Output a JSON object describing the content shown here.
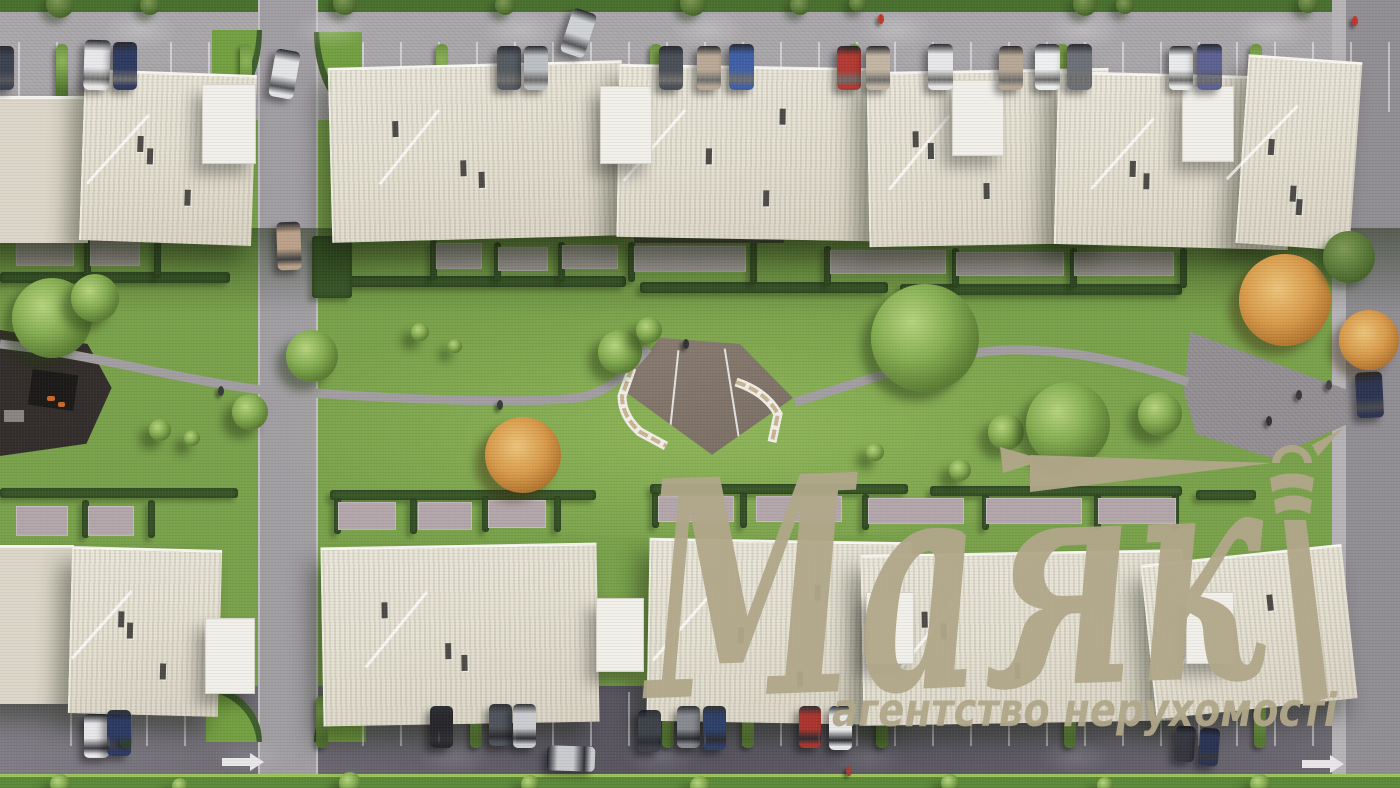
{
  "watermark": {
    "brand": "Маяк",
    "tagline": "агентство нерухомості",
    "logo_color": "#b1a78a",
    "icon": "lighthouse-with-light-beam"
  },
  "scene": {
    "description": "Top-down aerial 3D architectural render of a residential complex: two rows of cream low-rise buildings, central green courtyard with winding path, central plaza with curved benches, playground, parking strips with cars, roads on left and right",
    "palette": {
      "grass": "#7aa24c",
      "grass_shadow": "#3c5a2b",
      "road_light": "#a8a5a9",
      "asphalt_dark": "#585560",
      "building_roof": "#e6e2d4",
      "building_annex": "#f2f0ea",
      "hedge": "#3c5a2b",
      "plaza": "#8a7d72",
      "playground": "#332e2b",
      "autumn_tree": "#d89a4a",
      "green_tree": "#85ad52"
    },
    "buildings_top": [
      [
        -8,
        96,
        94,
        144,
        0,
        1
      ],
      [
        82,
        72,
        170,
        168,
        2,
        0
      ],
      [
        330,
        64,
        292,
        172,
        -1.5,
        0
      ],
      [
        618,
        66,
        252,
        170,
        1,
        0
      ],
      [
        868,
        70,
        240,
        172,
        -1,
        0
      ],
      [
        1056,
        74,
        232,
        170,
        1.5,
        0
      ],
      [
        1242,
        58,
        112,
        186,
        4,
        0
      ]
    ],
    "buildings_bottom": [
      [
        -8,
        545,
        80,
        156,
        0,
        1
      ],
      [
        70,
        548,
        148,
        164,
        1.5,
        0
      ],
      [
        322,
        545,
        274,
        176,
        -1,
        0
      ],
      [
        648,
        540,
        260,
        180,
        1,
        0
      ],
      [
        862,
        552,
        320,
        168,
        -1,
        0
      ],
      [
        1148,
        554,
        200,
        152,
        -6,
        0
      ]
    ],
    "annexes": [
      [
        202,
        84,
        52,
        78
      ],
      [
        600,
        86,
        50,
        76
      ],
      [
        952,
        80,
        50,
        74
      ],
      [
        1182,
        86,
        50,
        74
      ],
      [
        205,
        618,
        48,
        74
      ],
      [
        596,
        598,
        46,
        72
      ],
      [
        866,
        592,
        46,
        70
      ],
      [
        1186,
        592,
        46,
        70
      ]
    ],
    "cars": [
      [
        -10,
        46,
        24,
        44,
        0,
        "#3c4250"
      ],
      [
        84,
        40,
        26,
        50,
        2,
        "#e9e9eb"
      ],
      [
        113,
        42,
        24,
        48,
        0,
        "#2f3b60"
      ],
      [
        497,
        46,
        24,
        44,
        0,
        "#565b63"
      ],
      [
        524,
        46,
        24,
        44,
        0,
        "#bcbfc3"
      ],
      [
        659,
        46,
        24,
        44,
        0,
        "#4b4f57"
      ],
      [
        697,
        46,
        24,
        44,
        0,
        "#b9a996"
      ],
      [
        729,
        44,
        25,
        46,
        0,
        "#4060a6"
      ],
      [
        837,
        46,
        24,
        44,
        0,
        "#b23b33"
      ],
      [
        866,
        46,
        24,
        44,
        0,
        "#c3b5a3"
      ],
      [
        928,
        44,
        25,
        46,
        0,
        "#e8e8ea"
      ],
      [
        999,
        46,
        24,
        44,
        0,
        "#b7a795"
      ],
      [
        1035,
        44,
        25,
        46,
        0,
        "#eef0f1"
      ],
      [
        1067,
        44,
        25,
        46,
        0,
        "#6d7077"
      ],
      [
        1169,
        46,
        24,
        44,
        0,
        "#eaebec"
      ],
      [
        1197,
        44,
        25,
        46,
        0,
        "#5d6292"
      ],
      [
        566,
        10,
        25,
        46,
        18,
        "#d0d3d6"
      ],
      [
        272,
        50,
        25,
        48,
        10,
        "#e2e4e6"
      ],
      [
        277,
        222,
        24,
        48,
        -2,
        "#bba189"
      ],
      [
        1356,
        372,
        27,
        46,
        -3,
        "#2d3552"
      ],
      [
        84,
        714,
        25,
        44,
        0,
        "#e8e8ea"
      ],
      [
        107,
        710,
        24,
        46,
        0,
        "#2d3a62"
      ],
      [
        430,
        706,
        23,
        42,
        0,
        "#28282c"
      ],
      [
        489,
        704,
        23,
        42,
        0,
        "#50545c"
      ],
      [
        513,
        704,
        23,
        44,
        0,
        "#cbcdd0"
      ],
      [
        638,
        710,
        23,
        42,
        0,
        "#3e424a"
      ],
      [
        677,
        706,
        23,
        42,
        0,
        "#878a8f"
      ],
      [
        703,
        706,
        23,
        44,
        0,
        "#2e4068"
      ],
      [
        799,
        706,
        22,
        42,
        0,
        "#aa362f"
      ],
      [
        829,
        706,
        23,
        44,
        0,
        "#e8e9eb"
      ],
      [
        1175,
        726,
        20,
        36,
        4,
        "#35383f"
      ],
      [
        1199,
        728,
        20,
        38,
        4,
        "#2b3454"
      ],
      [
        547,
        746,
        48,
        25,
        2,
        "#c9cbce"
      ]
    ],
    "trees": [
      [
        52,
        318,
        40,
        "g"
      ],
      [
        95,
        298,
        24,
        "g"
      ],
      [
        312,
        356,
        26,
        "g"
      ],
      [
        250,
        412,
        18,
        "g"
      ],
      [
        160,
        430,
        11,
        "g"
      ],
      [
        192,
        438,
        8,
        "g"
      ],
      [
        420,
        332,
        9,
        "g"
      ],
      [
        455,
        346,
        7,
        "g"
      ],
      [
        523,
        455,
        38,
        "o"
      ],
      [
        620,
        352,
        22,
        "g"
      ],
      [
        649,
        330,
        13,
        "g"
      ],
      [
        925,
        338,
        54,
        "g"
      ],
      [
        1006,
        432,
        18,
        "g"
      ],
      [
        1068,
        424,
        42,
        "g"
      ],
      [
        1160,
        414,
        22,
        "g"
      ],
      [
        1285,
        300,
        46,
        "o"
      ],
      [
        1349,
        257,
        26,
        "d"
      ],
      [
        1369,
        340,
        30,
        "o"
      ],
      [
        960,
        470,
        11,
        "g"
      ],
      [
        875,
        452,
        9,
        "g"
      ],
      [
        60,
        4,
        14,
        "d"
      ],
      [
        150,
        5,
        10,
        "d"
      ],
      [
        345,
        3,
        12,
        "d"
      ],
      [
        505,
        5,
        10,
        "d"
      ],
      [
        693,
        3,
        13,
        "d"
      ],
      [
        800,
        5,
        10,
        "d"
      ],
      [
        858,
        3,
        9,
        "d"
      ],
      [
        1085,
        4,
        12,
        "d"
      ],
      [
        1125,
        5,
        9,
        "d"
      ],
      [
        1308,
        3,
        10,
        "d"
      ],
      [
        60,
        784,
        10,
        "g"
      ],
      [
        180,
        786,
        8,
        "g"
      ],
      [
        350,
        783,
        11,
        "g"
      ],
      [
        530,
        784,
        9,
        "g"
      ],
      [
        700,
        786,
        10,
        "g"
      ],
      [
        950,
        783,
        9,
        "g"
      ],
      [
        1105,
        785,
        8,
        "g"
      ],
      [
        1260,
        784,
        10,
        "g"
      ]
    ],
    "people": [
      [
        218,
        386,
        "#3a3a3a"
      ],
      [
        497,
        400,
        "#3a3a3a"
      ],
      [
        683,
        339,
        "#333333"
      ],
      [
        878,
        14,
        "#c0392b"
      ],
      [
        1352,
        16,
        "#c0392b"
      ],
      [
        1296,
        390,
        "#3a3a3a"
      ],
      [
        1266,
        416,
        "#333333"
      ],
      [
        1326,
        380,
        "#444444"
      ],
      [
        846,
        766,
        "#a04038"
      ]
    ],
    "hedges": [
      [
        0,
        272,
        230,
        11
      ],
      [
        330,
        276,
        296,
        11
      ],
      [
        640,
        282,
        248,
        11
      ],
      [
        900,
        284,
        282,
        11
      ],
      [
        84,
        238,
        7,
        40
      ],
      [
        154,
        238,
        7,
        40
      ],
      [
        430,
        240,
        7,
        40
      ],
      [
        494,
        242,
        7,
        40
      ],
      [
        558,
        242,
        7,
        40
      ],
      [
        628,
        242,
        7,
        40
      ],
      [
        750,
        240,
        7,
        44
      ],
      [
        824,
        246,
        7,
        40
      ],
      [
        952,
        248,
        7,
        40
      ],
      [
        1070,
        248,
        7,
        40
      ],
      [
        1180,
        248,
        7,
        40
      ],
      [
        312,
        236,
        40,
        62
      ],
      [
        1330,
        152,
        14,
        60
      ],
      [
        0,
        488,
        238,
        10
      ],
      [
        330,
        490,
        266,
        10
      ],
      [
        650,
        484,
        258,
        10
      ],
      [
        930,
        486,
        252,
        10
      ],
      [
        1196,
        490,
        60,
        10
      ],
      [
        82,
        500,
        7,
        38
      ],
      [
        148,
        500,
        7,
        38
      ],
      [
        334,
        498,
        7,
        36
      ],
      [
        410,
        498,
        7,
        36
      ],
      [
        482,
        496,
        7,
        36
      ],
      [
        554,
        496,
        7,
        36
      ],
      [
        652,
        492,
        7,
        36
      ],
      [
        740,
        492,
        7,
        36
      ],
      [
        862,
        494,
        7,
        36
      ],
      [
        982,
        494,
        7,
        36
      ],
      [
        1094,
        494,
        7,
        36
      ],
      [
        1172,
        494,
        7,
        36
      ]
    ],
    "patios": [
      [
        16,
        240,
        58,
        26
      ],
      [
        90,
        240,
        50,
        26
      ],
      [
        436,
        243,
        46,
        26
      ],
      [
        498,
        247,
        50,
        24
      ],
      [
        562,
        245,
        56,
        24
      ],
      [
        634,
        246,
        112,
        26
      ],
      [
        830,
        250,
        116,
        24
      ],
      [
        956,
        252,
        108,
        24
      ],
      [
        1074,
        252,
        100,
        24
      ],
      [
        16,
        506,
        52,
        30
      ],
      [
        88,
        506,
        46,
        30
      ],
      [
        338,
        502,
        58,
        28
      ],
      [
        418,
        502,
        54,
        28
      ],
      [
        488,
        500,
        58,
        28
      ],
      [
        658,
        496,
        76,
        26
      ],
      [
        756,
        496,
        86,
        26
      ],
      [
        868,
        498,
        96,
        26
      ],
      [
        986,
        498,
        96,
        26
      ],
      [
        1098,
        498,
        78,
        26
      ]
    ],
    "pergolas": [
      [
        634,
        230,
        150,
        13
      ]
    ],
    "hedge_separators_top_x": [
      56,
      240,
      436,
      650,
      848,
      1056,
      1250
    ],
    "hedge_separators_bottom_x": [
      120,
      316,
      470,
      662,
      742,
      876,
      1064,
      1254
    ],
    "light_pools_top_x": [
      140,
      330,
      520,
      708,
      896,
      1084,
      1272
    ],
    "light_pools_bottom_x": [
      250,
      455,
      660,
      868,
      1076
    ]
  }
}
